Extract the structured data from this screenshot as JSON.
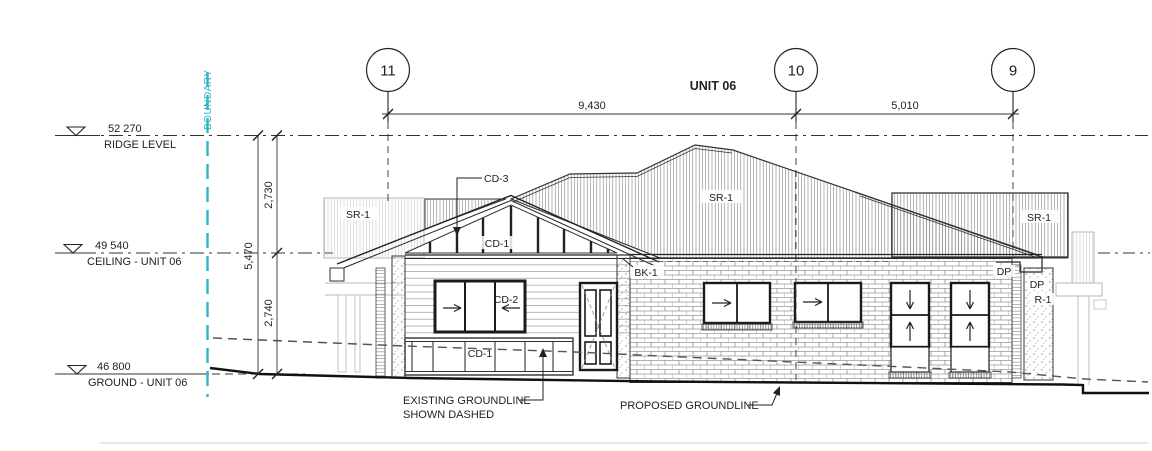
{
  "drawing": {
    "unit_title": "UNIT 06",
    "boundary": "BOUNDARY",
    "grids": [
      "11",
      "10",
      "9"
    ],
    "h_dims": [
      "9,430",
      "5,010"
    ],
    "v_dims": [
      "2,730",
      "5,470",
      "2,740"
    ],
    "levels": [
      {
        "value": "52 270",
        "label": "RIDGE LEVEL"
      },
      {
        "value": "49 540",
        "label": "CEILING - UNIT 06"
      },
      {
        "value": "46 800",
        "label": "GROUND - UNIT 06"
      }
    ],
    "materials": {
      "sr1_left": "SR-1",
      "sr1_main": "SR-1",
      "sr1_right": "SR-1",
      "cd3": "CD-3",
      "cd1_gable": "CD-1",
      "cd2": "CD-2",
      "cd1_band": "CD-1",
      "bk1": "BK-1",
      "dp_small": "DP",
      "dp": "DP",
      "r1": "R-1"
    },
    "notes": {
      "existing_1": "EXISTING GROUNDLINE",
      "existing_2": "SHOWN DASHED",
      "proposed": "PROPOSED GROUNDLINE"
    },
    "colors": {
      "boundary": "#2EB5C9",
      "line": "#222222",
      "faded": "#B8B8B8"
    }
  }
}
